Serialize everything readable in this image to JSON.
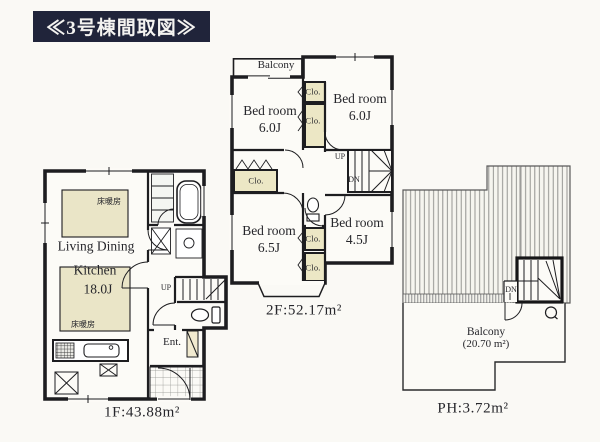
{
  "title": "≪3号棟間取図≫",
  "floor1": {
    "area_label": "1F:43.88m²",
    "living_dining_label": "Living Dining",
    "kitchen_label": "Kitchen",
    "kitchen_size": "18.0J",
    "floor_heating_top": "床暖房",
    "floor_heating_bottom": "床暖房",
    "entrance_label": "Ent.",
    "stairs_up_label": "UP"
  },
  "floor2": {
    "area_label": "2F:52.17m²",
    "balcony_label": "Balcony",
    "bedrooms": [
      {
        "id": "northwest",
        "name": "Bed room",
        "size": "6.0J"
      },
      {
        "id": "northeast",
        "name": "Bed room",
        "size": "6.0J"
      },
      {
        "id": "southwest",
        "name": "Bed room",
        "size": "6.5J"
      },
      {
        "id": "southeast",
        "name": "Bed room",
        "size": "4.5J"
      }
    ],
    "closets": [
      {
        "label": "Clo."
      },
      {
        "label": "Clo."
      },
      {
        "label": "Clo."
      },
      {
        "label": "Clo."
      },
      {
        "label": "Clo."
      }
    ],
    "stairs_up_label": "UP",
    "stairs_down_label": "DN"
  },
  "penthouse": {
    "area_label": "PH:3.72m²",
    "balcony_label": "Balcony",
    "balcony_area": "(20.70 m²)",
    "stairs_down_label": "DN"
  },
  "colors": {
    "title_background": "#20243a",
    "title_text": "#f4f3f0",
    "paper": "#faf9f5",
    "wall": "#1d1d20",
    "floor_heating_fill": "#eae5c7",
    "closet_fill": "#ece7c5"
  }
}
